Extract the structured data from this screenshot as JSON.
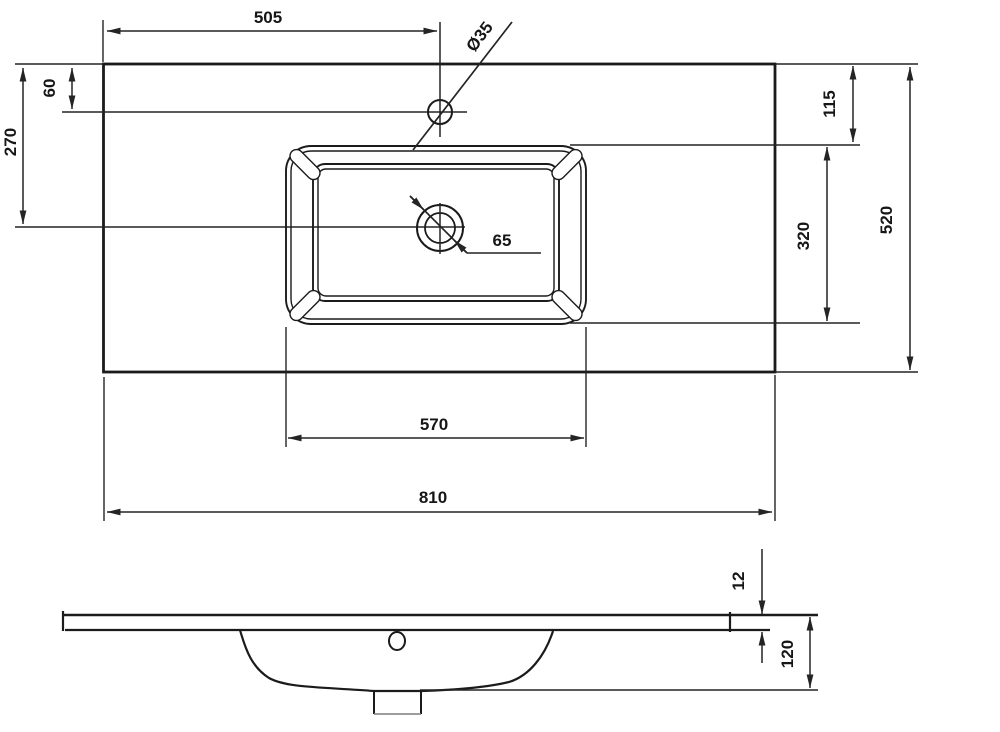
{
  "drawing": {
    "title": "Washbasin technical drawing (top view and side profile)",
    "colors": {
      "line": "#1b1b1b",
      "background": "#ffffff"
    },
    "views": {
      "top": {
        "dims": {
          "d505": "505",
          "d35": "Ø35",
          "d60": "60",
          "d270": "270",
          "d65": "65",
          "d115": "115",
          "d320": "320",
          "d520": "520",
          "d570": "570",
          "d810": "810"
        }
      },
      "side": {
        "dims": {
          "d12": "12",
          "d120": "120"
        }
      }
    }
  }
}
